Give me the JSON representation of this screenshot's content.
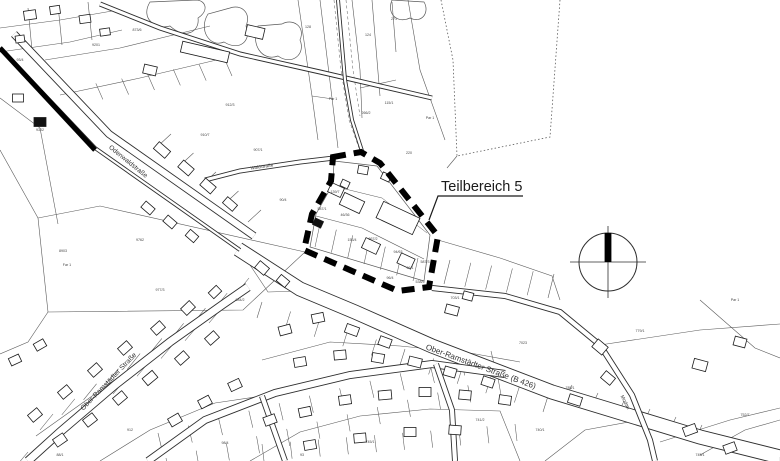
{
  "annotation": {
    "label": "Teilbereich 5"
  },
  "colors": {
    "paper": "#ffffff",
    "ink": "#1b1b1b",
    "road": "#2e2e2e",
    "parcel": "#5a5a5a",
    "boundary": "#000000",
    "label": "#333333"
  },
  "street_labels": [
    {
      "text": "Odenwaldstraße",
      "x": 127,
      "y": 163,
      "rot": 39,
      "size": 6.5
    },
    {
      "text": "Ober-Ramstädter Straße",
      "x": 110,
      "y": 383,
      "rot": -46,
      "size": 7
    },
    {
      "text": "Ober-Ramstädter Straße (B 426)",
      "x": 480,
      "y": 369,
      "rot": 20,
      "size": 8
    },
    {
      "text": "Waldstraße",
      "x": 262,
      "y": 168,
      "rot": -8,
      "size": 4.5
    },
    {
      "text": "Modau",
      "x": 624,
      "y": 403,
      "rot": 62,
      "size": 5
    }
  ],
  "parcel_labels": [
    {
      "t": "128",
      "x": 308,
      "y": 28
    },
    {
      "t": "124",
      "x": 368,
      "y": 36
    },
    {
      "t": "271",
      "x": 394,
      "y": 20
    },
    {
      "t": "Par 1",
      "x": 333,
      "y": 100
    },
    {
      "t": "115/1",
      "x": 389,
      "y": 104
    },
    {
      "t": "266/2",
      "x": 366,
      "y": 114
    },
    {
      "t": "220",
      "x": 409,
      "y": 154
    },
    {
      "t": "Par 1",
      "x": 430,
      "y": 119
    },
    {
      "t": "8903",
      "x": 63,
      "y": 252
    },
    {
      "t": "Far 1",
      "x": 67,
      "y": 266
    },
    {
      "t": "9762",
      "x": 140,
      "y": 241
    },
    {
      "t": "9302",
      "x": 40,
      "y": 131
    },
    {
      "t": "93/4",
      "x": 20,
      "y": 61
    },
    {
      "t": "9201",
      "x": 96,
      "y": 46
    },
    {
      "t": "873/6",
      "x": 137,
      "y": 31
    },
    {
      "t": "912/3",
      "x": 230,
      "y": 106
    },
    {
      "t": "910/7",
      "x": 205,
      "y": 136
    },
    {
      "t": "907/1",
      "x": 258,
      "y": 151
    },
    {
      "t": "90/4",
      "x": 283,
      "y": 201
    },
    {
      "t": "587/1",
      "x": 322,
      "y": 210
    },
    {
      "t": "46/36",
      "x": 345,
      "y": 216
    },
    {
      "t": "153/4",
      "x": 352,
      "y": 241
    },
    {
      "t": "867/2",
      "x": 373,
      "y": 240
    },
    {
      "t": "94/63",
      "x": 398,
      "y": 253
    },
    {
      "t": "96/1",
      "x": 410,
      "y": 269
    },
    {
      "t": "587/3",
      "x": 425,
      "y": 263
    },
    {
      "t": "96/4",
      "x": 390,
      "y": 279
    },
    {
      "t": "538/5",
      "x": 420,
      "y": 283
    },
    {
      "t": "139/7",
      "x": 335,
      "y": 193
    },
    {
      "t": "984/2",
      "x": 240,
      "y": 301
    },
    {
      "t": "977/3",
      "x": 160,
      "y": 291
    },
    {
      "t": "703/1",
      "x": 455,
      "y": 299
    },
    {
      "t": "7023",
      "x": 523,
      "y": 344
    },
    {
      "t": "785/1",
      "x": 570,
      "y": 389
    },
    {
      "t": "779/1",
      "x": 640,
      "y": 332
    },
    {
      "t": "Par 1",
      "x": 735,
      "y": 301
    },
    {
      "t": "752/7",
      "x": 745,
      "y": 416
    },
    {
      "t": "745/1",
      "x": 700,
      "y": 456
    },
    {
      "t": "740/1",
      "x": 540,
      "y": 431
    },
    {
      "t": "741/2",
      "x": 480,
      "y": 421
    },
    {
      "t": "93",
      "x": 302,
      "y": 456
    },
    {
      "t": "745/1",
      "x": 370,
      "y": 443
    },
    {
      "t": "98/4",
      "x": 225,
      "y": 444
    },
    {
      "t": "912",
      "x": 130,
      "y": 431
    },
    {
      "t": "88/1",
      "x": 60,
      "y": 456
    }
  ],
  "map": {
    "roads": [
      {
        "name": "top-diagonal-road",
        "d": "M 100,4 L 160,28 L 240,54 L 320,72 L 432,98",
        "w": 5
      },
      {
        "name": "odenwaldstrasse-road",
        "d": "M 14,34 L 109,134 L 254,236",
        "w": 8
      },
      {
        "name": "b426-road",
        "d": "M 238,249 L 300,289 L 355,312 L 432,346 L 552,392 L 700,437 L 780,457",
        "w": 15
      },
      {
        "name": "ober-ramstaedter-road",
        "d": "M 28,461 L 60,432 L 115,385 L 170,342 L 222,305 L 248,287",
        "w": 9
      },
      {
        "name": "residential-street",
        "d": "M 148,461 L 205,420 L 275,393 L 350,375 L 432,364 L 505,374",
        "w": 8
      },
      {
        "name": "cross-lane-1",
        "d": "M 262,396 L 285,461",
        "w": 6
      },
      {
        "name": "cross-lane-2",
        "d": "M 436,364 L 452,410 L 455,461",
        "w": 6
      },
      {
        "name": "waldstrasse-road",
        "d": "M 205,180 L 240,171 L 300,162 L 334,158",
        "w": 5
      },
      {
        "name": "north-path",
        "d": "M 338,0 L 345,80 L 352,120 L 362,151",
        "w": 4
      },
      {
        "name": "modau-corridor",
        "d": "M 432,288 L 505,296 L 560,312 L 600,345 L 632,395 L 650,440 L 655,461",
        "w": 6
      },
      {
        "name": "railway-casing",
        "d": "M 0,48 L 95,148 L 240,250",
        "w": 4
      }
    ],
    "parcel_lines": [
      {
        "d": "M 38,218 L 100,206 L 305,252 L 243,310 L 48,312 Z"
      },
      {
        "d": "M 0,98 L 40,128 L 58,224"
      },
      {
        "d": "M 0,150 L 38,218"
      },
      {
        "d": "M 48,312 L 28,342 L 0,354"
      },
      {
        "d": "M 36,436 L 238,292"
      },
      {
        "d": "M 100,461 L 150,430 L 215,403 L 262,396"
      },
      {
        "d": "M 250,461 L 300,432 L 360,416 L 430,409 L 500,411 L 520,461"
      },
      {
        "d": "M 262,360 L 330,342 L 400,346 L 470,353 L 520,362"
      },
      {
        "d": "M 244,256 L 268,292 L 302,291"
      },
      {
        "d": "M 600,345 L 700,330 L 780,324"
      },
      {
        "d": "M 660,442 L 730,420 L 780,408"
      },
      {
        "d": "M 700,300 L 755,348 L 780,358"
      },
      {
        "d": "M 438,240 L 500,258 L 552,276 L 560,300"
      },
      {
        "d": "M 334,161 L 377,166 L 430,235 L 424,281 L 310,247 L 316,214 L 333,184 Z",
        "w": 0.7
      },
      {
        "d": "M 316,216 L 362,228 L 424,259"
      },
      {
        "d": "M 333,186 L 382,198 L 427,233",
        "w": 0.5
      },
      {
        "d": "M 560,0 L 550,137 L 457,156",
        "dash": "1.5,2.2",
        "w": 0.8
      },
      {
        "d": "M 441,0 L 453,60 L 457,156",
        "dash": "1.5,2.2",
        "w": 0.8
      },
      {
        "d": "M 457,156 L 447,168"
      },
      {
        "d": "M 298,0 L 312,96 L 318,140"
      },
      {
        "d": "M 320,0 L 332,98 L 338,148"
      },
      {
        "d": "M 352,0 L 360,70 L 362,118"
      },
      {
        "d": "M 372,0 L 377,60 L 380,96"
      },
      {
        "d": "M 392,2 L 396,52"
      },
      {
        "d": "M 408,0 L 420,70 L 445,140"
      },
      {
        "d": "M 312,96 L 333,99"
      },
      {
        "d": "M 360,88 L 396,80"
      },
      {
        "d": "M 334,0 L 341,70 L 349,120 L 359,148",
        "dash": "3,2.5",
        "w": 0.5
      },
      {
        "d": "M 346,0 L 353,70 L 360,116",
        "dash": "3,2.5",
        "w": 0.5
      },
      {
        "d": "M 45,60 L 120,48 L 210,26"
      },
      {
        "d": "M 60,95 L 140,78 L 225,58"
      },
      {
        "d": "M 0,28 L 60,20 L 118,10"
      },
      {
        "d": "M 0,52 L 70,42 L 122,30"
      },
      {
        "d": "M 28,8 L 32,50"
      },
      {
        "d": "M 58,5 L 62,45"
      },
      {
        "d": "M 88,2 L 92,40"
      },
      {
        "d": "M 545,461 L 585,430 L 640,420"
      },
      {
        "d": "M 700,455 L 745,430 L 780,420"
      }
    ],
    "ticks": [
      {
        "x1": 40,
        "y1": 430,
        "x2": 236,
        "y2": 294,
        "n": 10,
        "dx": 13,
        "dy": -16
      },
      {
        "x1": 28,
        "y1": 452,
        "x2": 220,
        "y2": 310,
        "n": 9,
        "dx": -11,
        "dy": 13
      },
      {
        "x1": 162,
        "y1": 450,
        "x2": 495,
        "y2": 368,
        "n": 12,
        "dx": -4,
        "dy": -17
      },
      {
        "x1": 166,
        "y1": 458,
        "x2": 498,
        "y2": 378,
        "n": 12,
        "dx": 3,
        "dy": 17
      },
      {
        "x1": 262,
        "y1": 302,
        "x2": 548,
        "y2": 396,
        "n": 11,
        "dx": -5,
        "dy": 16
      },
      {
        "x1": 262,
        "y1": 444,
        "x2": 515,
        "y2": 424,
        "n": 10,
        "dx": 2,
        "dy": 17
      },
      {
        "x1": 444,
        "y1": 284,
        "x2": 548,
        "y2": 298,
        "n": 6,
        "dx": 6,
        "dy": -24
      },
      {
        "x1": 320,
        "y1": 224,
        "x2": 418,
        "y2": 258,
        "n": 7,
        "dx": -5,
        "dy": 23
      },
      {
        "x1": 158,
        "y1": 146,
        "x2": 248,
        "y2": 222,
        "n": 5,
        "dx": 13,
        "dy": -12
      },
      {
        "x1": 70,
        "y1": 88,
        "x2": 225,
        "y2": 60,
        "n": 7,
        "dx": 7,
        "dy": 16
      },
      {
        "x1": 565,
        "y1": 400,
        "x2": 695,
        "y2": 440,
        "n": 6,
        "dx": 7,
        "dy": -15
      }
    ],
    "houses": [
      [
        30,
        15,
        12,
        9,
        -8
      ],
      [
        55,
        10,
        10,
        8,
        -8
      ],
      [
        85,
        19,
        11,
        8,
        -8
      ],
      [
        20,
        39,
        9,
        7,
        -8
      ],
      [
        105,
        32,
        10,
        7,
        -8
      ],
      [
        205,
        52,
        48,
        11,
        13
      ],
      [
        255,
        32,
        18,
        11,
        13
      ],
      [
        150,
        70,
        13,
        9,
        13
      ],
      [
        162,
        150,
        15,
        9,
        41
      ],
      [
        186,
        168,
        14,
        9,
        41
      ],
      [
        208,
        186,
        14,
        9,
        41
      ],
      [
        230,
        204,
        13,
        8,
        41
      ],
      [
        148,
        208,
        12,
        8,
        41
      ],
      [
        170,
        222,
        12,
        8,
        41
      ],
      [
        192,
        236,
        11,
        8,
        41
      ],
      [
        40,
        122,
        12,
        9,
        0,
        "dark"
      ],
      [
        18,
        98,
        11,
        8,
        0
      ],
      [
        262,
        268,
        12,
        9,
        40
      ],
      [
        283,
        281,
        11,
        8,
        40
      ],
      [
        398,
        218,
        40,
        18,
        25
      ],
      [
        352,
        203,
        22,
        13,
        25
      ],
      [
        336,
        190,
        14,
        10,
        25
      ],
      [
        345,
        184,
        8,
        7,
        25
      ],
      [
        371,
        246,
        16,
        11,
        25
      ],
      [
        406,
        261,
        15,
        11,
        25
      ],
      [
        318,
        223,
        9,
        7,
        25,
        "dark"
      ],
      [
        363,
        170,
        10,
        8,
        10
      ],
      [
        386,
        177,
        9,
        7,
        25
      ],
      [
        452,
        310,
        13,
        9,
        15
      ],
      [
        468,
        296,
        10,
        8,
        15
      ],
      [
        285,
        330,
        12,
        9,
        -15
      ],
      [
        318,
        318,
        12,
        9,
        -12
      ],
      [
        352,
        330,
        13,
        9,
        20
      ],
      [
        385,
        342,
        12,
        9,
        20
      ],
      [
        300,
        362,
        12,
        9,
        -10
      ],
      [
        340,
        355,
        12,
        9,
        -5
      ],
      [
        378,
        358,
        12,
        9,
        10
      ],
      [
        415,
        362,
        13,
        9,
        14
      ],
      [
        450,
        372,
        12,
        9,
        16
      ],
      [
        488,
        382,
        12,
        9,
        18
      ],
      [
        270,
        420,
        12,
        9,
        -20
      ],
      [
        305,
        412,
        12,
        9,
        -12
      ],
      [
        345,
        400,
        12,
        9,
        -8
      ],
      [
        385,
        395,
        13,
        9,
        -5
      ],
      [
        425,
        392,
        12,
        9,
        0
      ],
      [
        465,
        395,
        12,
        9,
        5
      ],
      [
        505,
        400,
        12,
        9,
        8
      ],
      [
        310,
        445,
        12,
        9,
        -10
      ],
      [
        360,
        438,
        12,
        9,
        -5
      ],
      [
        410,
        432,
        12,
        9,
        0
      ],
      [
        455,
        430,
        12,
        9,
        4
      ],
      [
        60,
        440,
        12,
        9,
        -35
      ],
      [
        90,
        420,
        12,
        9,
        -38
      ],
      [
        120,
        398,
        12,
        9,
        -40
      ],
      [
        150,
        378,
        13,
        9,
        -40
      ],
      [
        182,
        358,
        12,
        9,
        -42
      ],
      [
        212,
        338,
        12,
        9,
        -42
      ],
      [
        175,
        420,
        12,
        9,
        -30
      ],
      [
        205,
        402,
        12,
        9,
        -28
      ],
      [
        235,
        385,
        12,
        9,
        -25
      ],
      [
        35,
        415,
        12,
        9,
        -40
      ],
      [
        65,
        392,
        12,
        9,
        -40
      ],
      [
        95,
        370,
        12,
        9,
        -42
      ],
      [
        125,
        348,
        12,
        9,
        -42
      ],
      [
        158,
        328,
        12,
        9,
        -42
      ],
      [
        188,
        308,
        12,
        9,
        -44
      ],
      [
        215,
        292,
        11,
        8,
        -44
      ],
      [
        15,
        360,
        11,
        8,
        -25
      ],
      [
        40,
        345,
        11,
        8,
        -30
      ],
      [
        575,
        400,
        13,
        9,
        18
      ],
      [
        608,
        378,
        12,
        9,
        40
      ],
      [
        600,
        347,
        13,
        10,
        40
      ],
      [
        700,
        365,
        14,
        10,
        15
      ],
      [
        740,
        342,
        12,
        9,
        15
      ],
      [
        690,
        430,
        13,
        9,
        -20
      ],
      [
        730,
        448,
        12,
        9,
        -20
      ]
    ],
    "forest_blobs": [
      "M 150,2 C 140,18 155,30 170,26 C 185,40 200,32 198,18 C 210,10 205,0 196,0 Z",
      "M 208,14 C 198,30 210,48 224,42 C 240,52 252,40 246,26 C 252,12 240,4 230,8 Z",
      "M 258,26 C 250,44 262,62 278,56 C 292,66 306,54 300,40 C 306,26 292,18 282,24 Z",
      "M 392,0 C 386,14 398,24 410,18 C 422,24 430,12 424,2 Z"
    ],
    "boundary_path": "M 333,157 L 361,152 L 380,163 L 438,236 L 429,287 L 398,291 L 304,250 L 312,214 L 331,181 Z",
    "railway_thick": "M 0,48 L 95,150",
    "leader_path": "M 523,196 L 438,196 L 429,220",
    "compass": {
      "cx": 608,
      "cy": 262,
      "r": 29
    }
  }
}
